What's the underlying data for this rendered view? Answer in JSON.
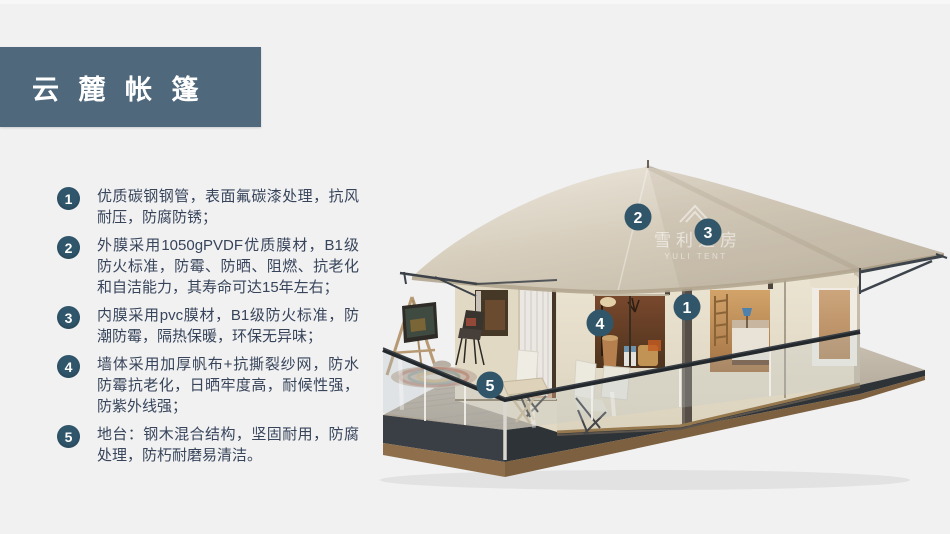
{
  "page": {
    "background": "#f1f1f2"
  },
  "header": {
    "title": "云 麓 帐 篷",
    "bar_color": "#50687c",
    "text_color": "#ffffff"
  },
  "features": [
    {
      "num": "1",
      "text": "优质碳钢钢管，表面氟碳漆处理，抗风耐压，防腐防锈；"
    },
    {
      "num": "2",
      "text": "外膜采用1050gPVDF优质膜材，B1级防火标准，防霉、防晒、阻燃、抗老化和自洁能力，其寿命可达15年左右；"
    },
    {
      "num": "3",
      "text": "内膜采用pvc膜材，B1级防火标准，防潮防霉，隔热保暖，环保无异味；"
    },
    {
      "num": "4",
      "text": "墙体采用加厚帆布+抗撕裂纱网，防水防霉抗老化，日晒牢度高，耐候性强，防紫外线强；"
    },
    {
      "num": "5",
      "text": "地台：钢木混合结构，坚固耐用，防腐处理，防朽耐磨易清洁。"
    }
  ],
  "illustration": {
    "description": "3D render of a glamping safari tent with wooden deck, glass railing and numbered part callouts",
    "watermark": {
      "cn": "雪利篷房",
      "en": "YULI TENT"
    },
    "markers": [
      {
        "num": "1"
      },
      {
        "num": "2"
      },
      {
        "num": "3"
      },
      {
        "num": "4"
      },
      {
        "num": "5"
      }
    ],
    "colors": {
      "marker": "#325669",
      "roof": "#d9d2c4",
      "wall": "#e8e1cf",
      "deck_wood": "#8f6f4b",
      "fascia": "#3a3f45"
    }
  }
}
